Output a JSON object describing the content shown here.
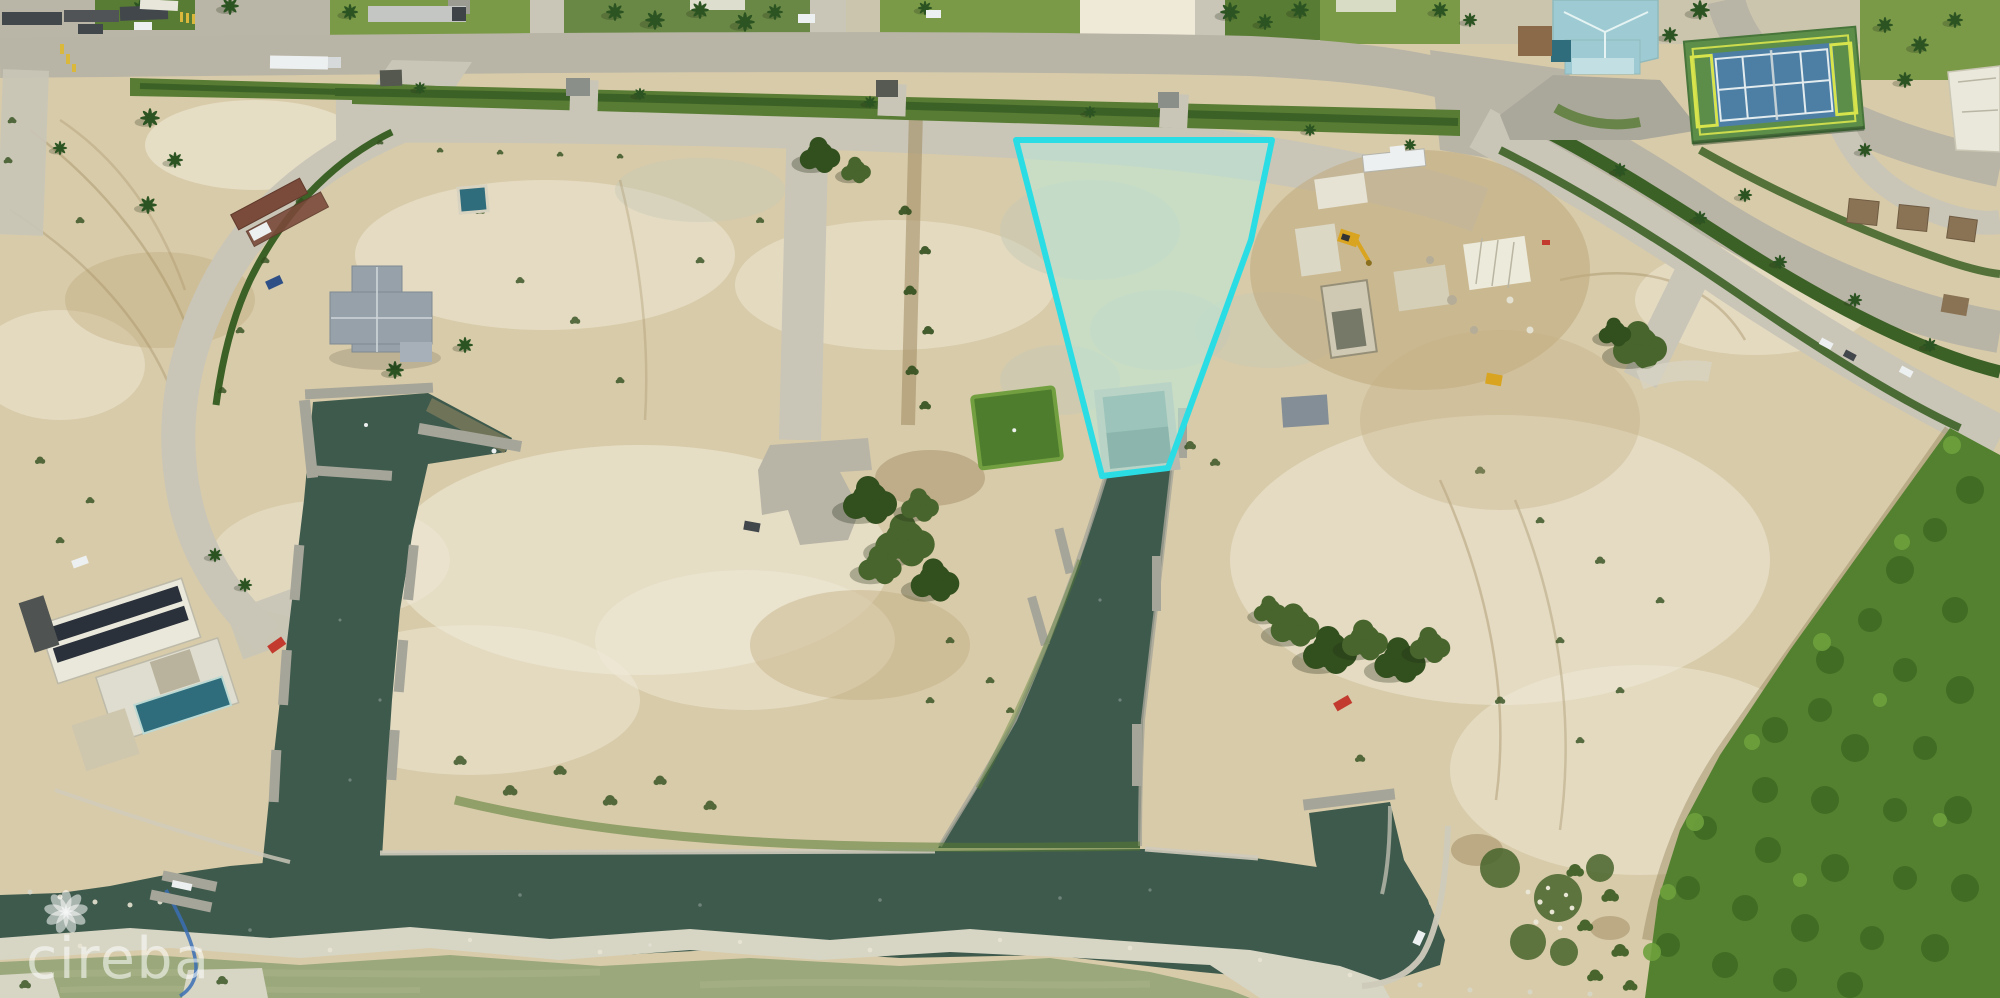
{
  "image": {
    "width": 2000,
    "height": 998,
    "kind": "aerial-drone-photo"
  },
  "watermark": {
    "text": "cireba",
    "logo": "flower-rosette-icon"
  },
  "highlighted_lot": {
    "outline_points": "1016,140 1272,140 1251,240 1168,468 1102,476",
    "outline_color": "#2adde4",
    "fill_color": "rgba(185,238,224,0.5)",
    "stroke_width": 6
  },
  "colors": {
    "sand": "#d8cba9",
    "sand_light": "#e6dcc0",
    "sand_bright": "#efe9d7",
    "marl": "#c6c9b6",
    "dirt": "#c0a97e",
    "dirt_dark": "#9f8a5f",
    "road": "#b8b4a6",
    "road_light": "#c9c5b7",
    "road_pale": "#d8d4c6",
    "hedge": "#3c6126",
    "lawn": "#7b9a48",
    "lawn_dark": "#587c33",
    "turf": "#4f7d2e",
    "turf_light": "#72a040",
    "tree": "#48652d",
    "tree_dark": "#324f1e",
    "palm": "#2c5422",
    "mangrove": "#538130",
    "mangrove_dark": "#3e6922",
    "mangrove_light": "#6ea13d",
    "mangrove_edge": "#94845a",
    "canal": "#3e5a4d",
    "canal_dark": "#2f4c3c",
    "sea": "#9aa87c",
    "sea_light": "#abb58a",
    "rock": "#d7d5c4",
    "seawall": "#cfcabb",
    "dock": "#a6a599",
    "slip_wall": "#b9b9ad",
    "slip_water": "#7e9a94",
    "roof_teal": "#9ecbd3",
    "roof_teal_light": "#c2e0e4",
    "roof_gray": "#96a1aa",
    "roof_white": "#eae8db",
    "court_green": "#5d8e49",
    "court_blue": "#4d7ea4",
    "line_yellow": "#d8e44c",
    "line_white": "#e2ebee",
    "pool": "#2f6d7c",
    "solar": "#2b313a",
    "container": "#7a4a3a",
    "gazebo": "#8a7355",
    "vehicle_white": "#edf0f0",
    "vehicle_dark": "#42474c",
    "vehicle_red": "#c23b2e",
    "vehicle_blue": "#2e5087",
    "machine_yellow": "#d9a41f",
    "boom_blue": "#3a6fb5",
    "crosswalk": "#d9b83c",
    "lot_outline": "#2adde4",
    "lot_fill": "rgba(185,238,224,0.5)",
    "watermark": "rgba(255,255,255,0.55)"
  }
}
